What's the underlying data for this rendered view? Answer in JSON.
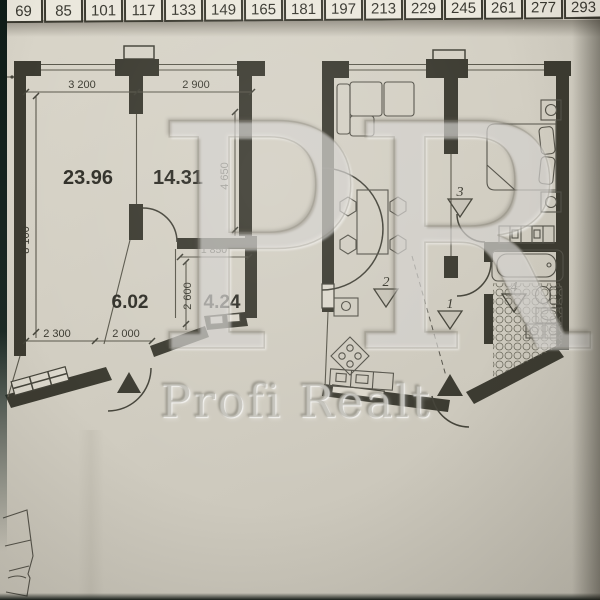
{
  "ruler": {
    "values": [
      "69",
      "85",
      "101",
      "117",
      "133",
      "149",
      "165",
      "181",
      "197",
      "213",
      "229",
      "245",
      "261",
      "277",
      "293"
    ]
  },
  "watermark": {
    "monogram": "PR",
    "brand": "Profi Realt"
  },
  "plan_left": {
    "room_labels": {
      "living": "23.96",
      "bedroom": "14.31",
      "hall": "6.02",
      "bathroom": "4.24"
    },
    "dimensions": {
      "top_left": "3 200",
      "top_right": "2 900",
      "left_height": "8 100",
      "bedroom_height": "4 650",
      "bathroom_width": "1 850",
      "bathroom_height": "2 600",
      "bottom_left": "2 300",
      "bottom_mid": "2 000"
    }
  },
  "plan_right": {
    "zone_markers": {
      "hall": "1",
      "kitchen_living": "2",
      "bedroom": "3",
      "bathroom": "4"
    }
  },
  "colors": {
    "paper": "#d3cfc3",
    "wall": "#3c3b31",
    "ruler_bg": "#ebe8dd",
    "line": "#57554a",
    "watermark": "#b3b0a4"
  }
}
